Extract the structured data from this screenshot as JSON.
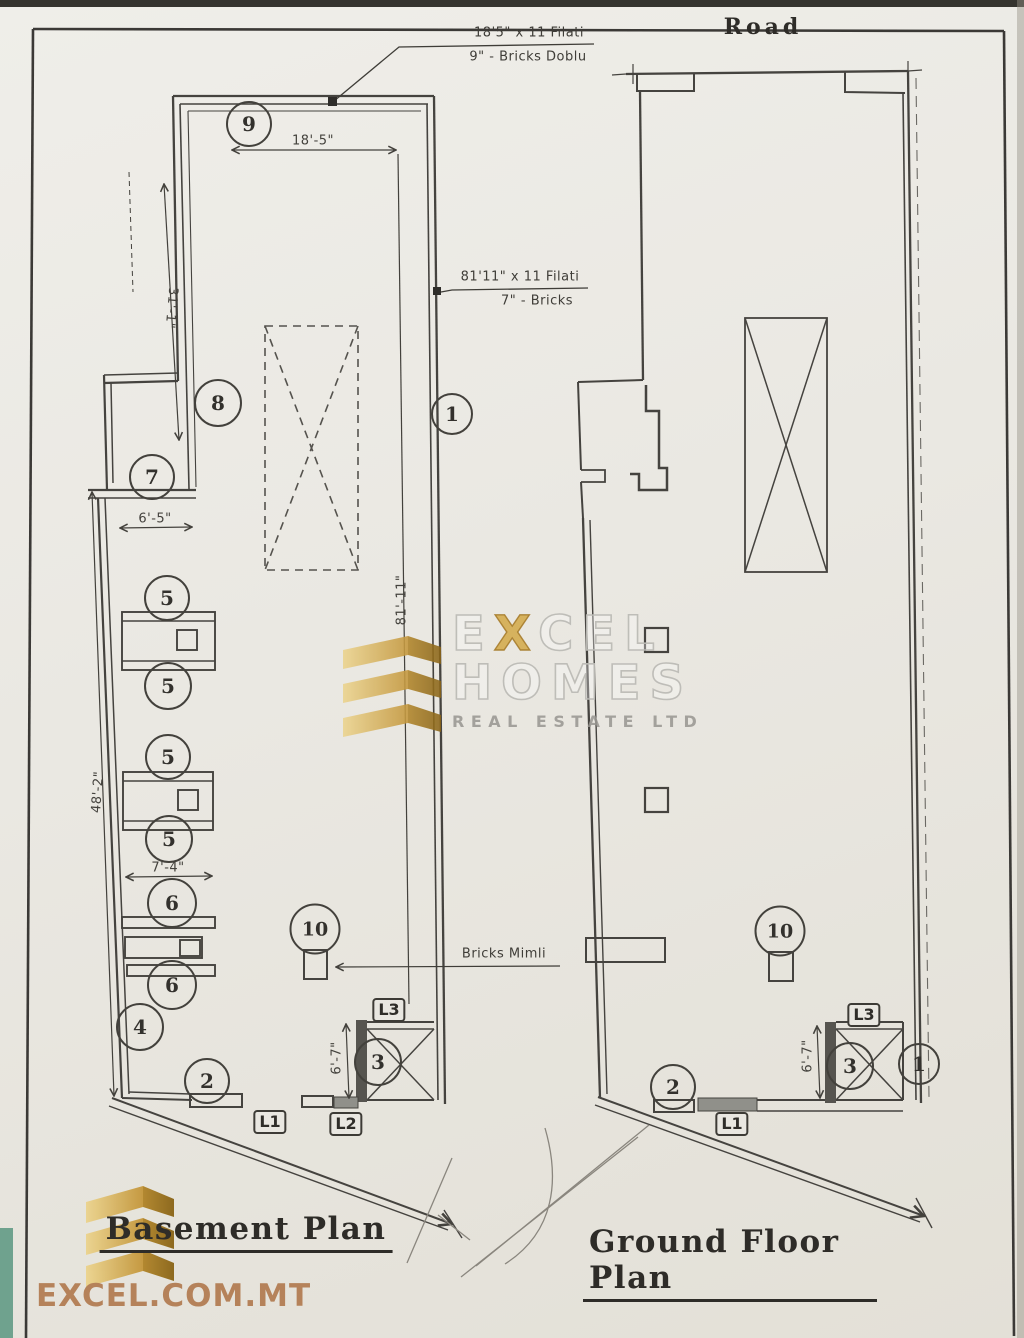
{
  "titles": {
    "road": "Road",
    "basement": "Basement Plan",
    "ground_floor": "Ground Floor Plan"
  },
  "annotations": {
    "filati_top_line1": "18'5\" x 11 Filati",
    "filati_top_line2": "9\" - Bricks Doblu",
    "filati_mid_line1": "81'11\" x 11 Filati",
    "filati_mid_line2": "7\" - Bricks",
    "bricks_mimli": "Bricks Mimli"
  },
  "dimensions": {
    "top_width": "18'-5\"",
    "upper_left_height": "31'-1\"",
    "recess_width": "6'-5\"",
    "lower_left_height": "48'-2\"",
    "stair_width": "7'-4\"",
    "right_height": "81'-11\"",
    "lift_left": "6'-7\"",
    "lift_right": "6'-7\""
  },
  "markers": {
    "m9": "9",
    "m8": "8",
    "m7": "7",
    "m4": "4",
    "m5a": "5",
    "m5b": "5",
    "m5c": "5",
    "m5d": "5",
    "m6a": "6",
    "m6b": "6",
    "m1_left": "1",
    "m2_left": "2",
    "m3_left": "3",
    "m10_left": "10",
    "m1_right": "1",
    "m2_right": "2",
    "m3_right": "3",
    "m10_right": "10"
  },
  "lintel_labels": {
    "l1_left": "L1",
    "l2_left": "L2",
    "l3_left": "L3",
    "l1_right": "L1",
    "l3_right": "L3"
  },
  "branding": {
    "watermark_e": "E",
    "watermark_x": "X",
    "watermark_cel": "CEL",
    "watermark_homes": "HOMES",
    "watermark_subtitle": "REAL ESTATE LTD",
    "website": "EXCEL.COM.MT"
  },
  "colors": {
    "ink": "#45433f",
    "gold": "#d8b85a",
    "gold_dark": "#a07820",
    "tan_text": "#b5825a",
    "paper": "#e9e8e3"
  }
}
